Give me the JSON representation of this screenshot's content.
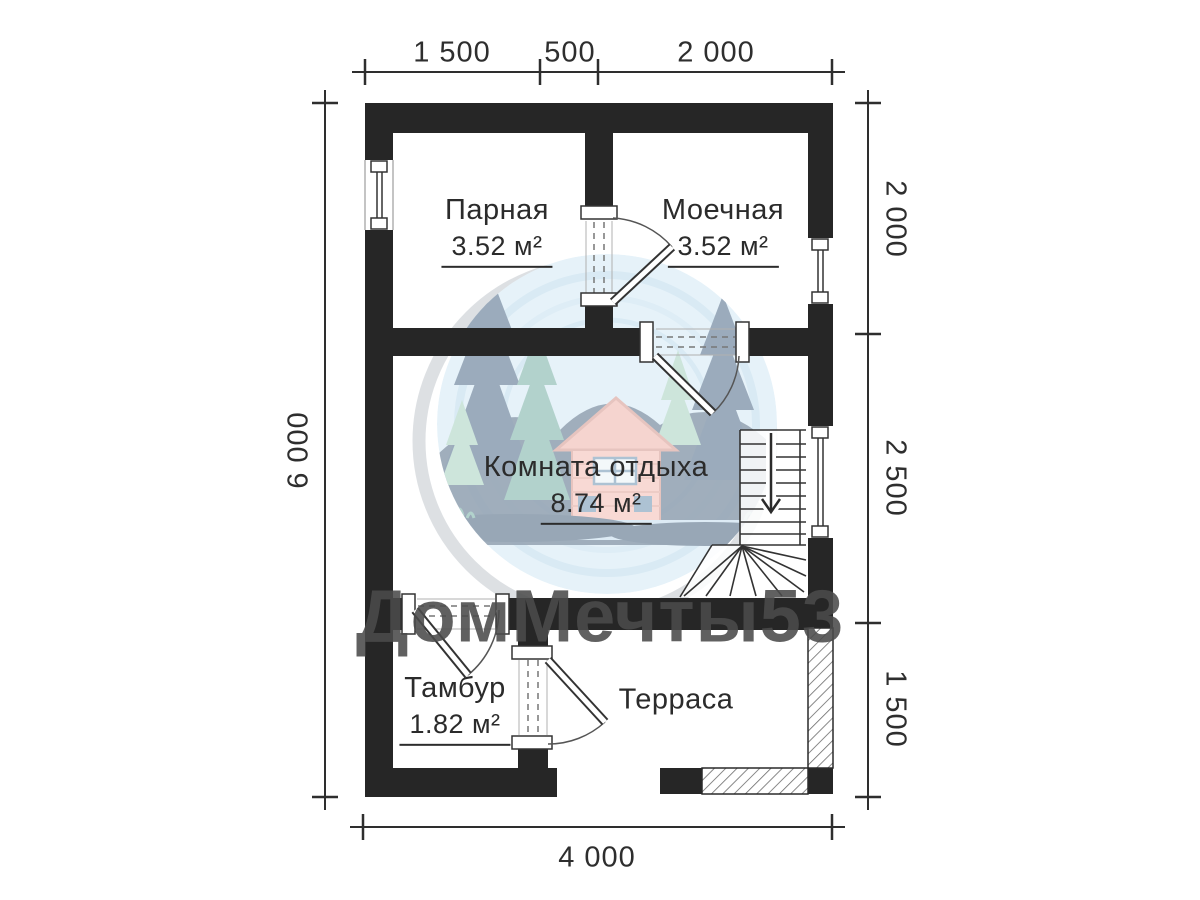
{
  "title": "Floor plan of sauna / bathhouse, first floor",
  "watermark": {
    "text": "ДомМечты53"
  },
  "dimensions": {
    "top": [
      "1 500",
      "500",
      "2 000"
    ],
    "right": [
      "2 000",
      "2 500",
      "1 500"
    ],
    "left": "6 000",
    "bottom": "4 000"
  },
  "rooms": [
    {
      "name": "Парная",
      "area": "3.52 м²"
    },
    {
      "name": "Моечная",
      "area": "3.52 м²"
    },
    {
      "name": "Комната отдыха",
      "area": "8.74 м²"
    },
    {
      "name": "Тамбур",
      "area": "1.82 м²"
    },
    {
      "name": "Терраса",
      "area": ""
    }
  ],
  "colors": {
    "wall": "#262626",
    "dimension_lines": "#2e2e2e",
    "watermark": "#4b4b4b",
    "logo_circle": "#cfe7f5",
    "logo_navy": "#33516f",
    "logo_teal": "#68a79b",
    "logo_light_green": "#9ccdb8",
    "logo_house_wall": "#f2b5ab",
    "logo_house_roof": "#edaaa0"
  }
}
